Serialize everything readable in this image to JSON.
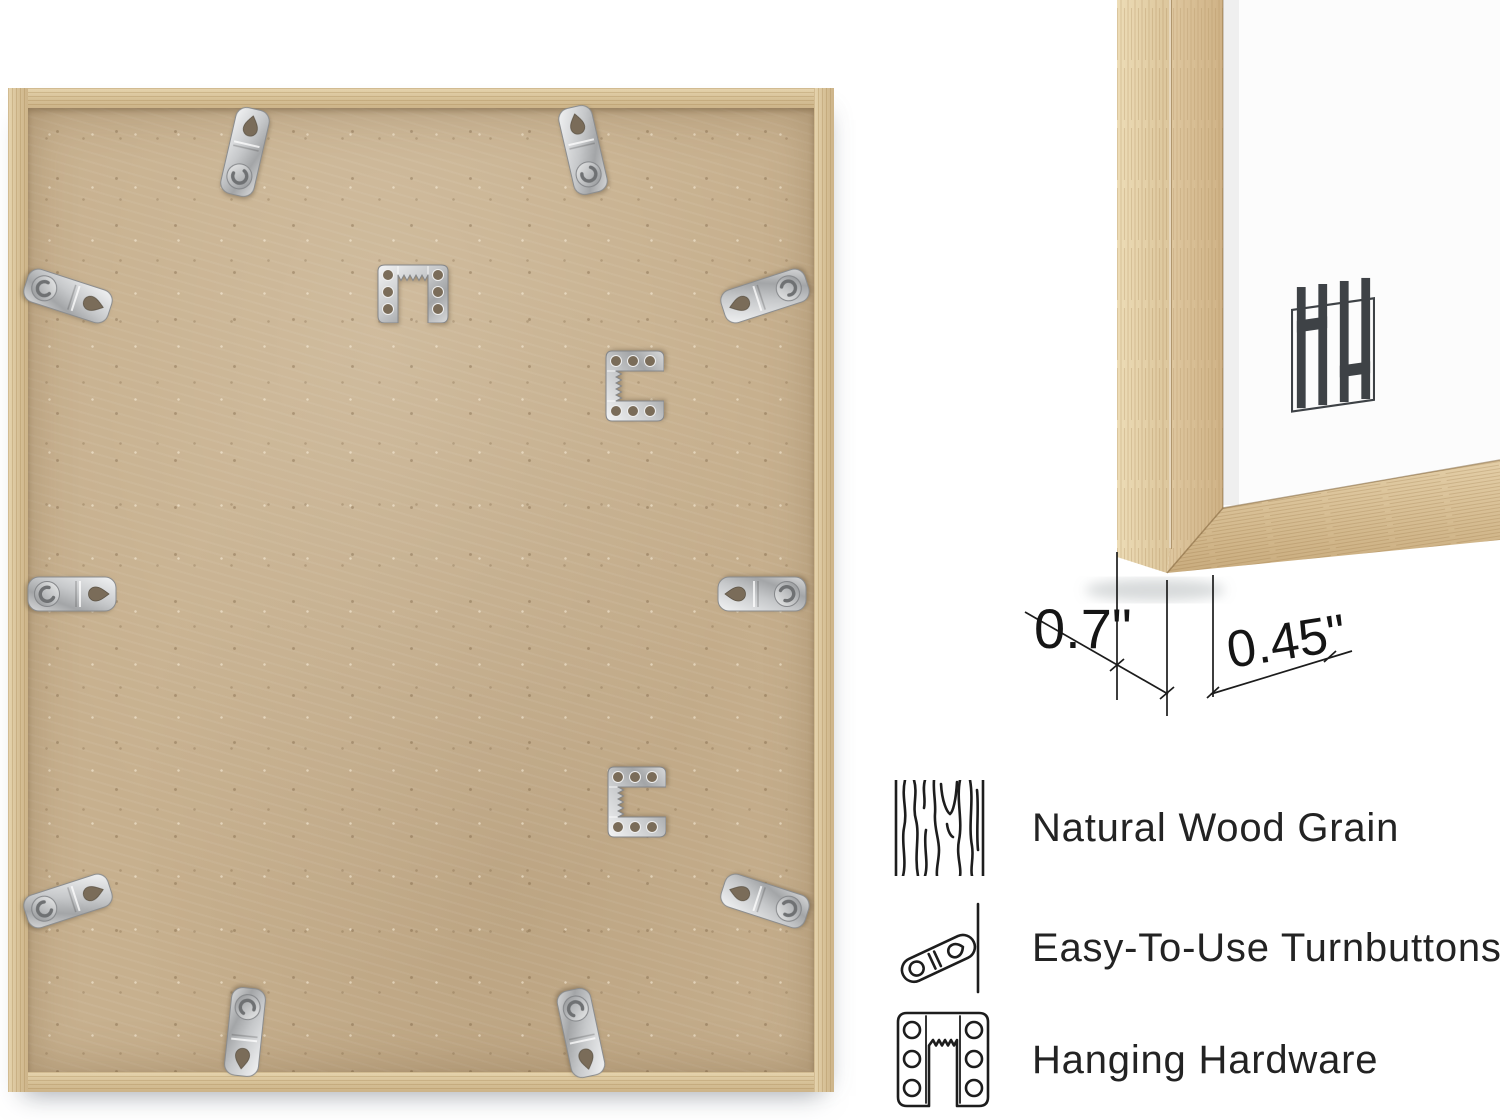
{
  "page": {
    "background": "#ffffff"
  },
  "back_frame_photo": {
    "description": "Back of natural oak picture frame with MDF backing board",
    "wood_color": "#d9c49c",
    "backing_color": "#c7b08e",
    "metal_color": "#c9cbcd",
    "turnbutton_count": 10,
    "sawtooth_hanger_count": 3
  },
  "corner_photo": {
    "description": "Front bottom corner of natural oak frame with white mat",
    "logo_text": "HH",
    "logo_color": "#3e4246",
    "dimensions": [
      {
        "label": "0.7\""
      },
      {
        "label": "0.45\""
      }
    ]
  },
  "features": [
    {
      "icon": "wood-grain-icon",
      "label": "Natural Wood Grain"
    },
    {
      "icon": "turnbutton-icon",
      "label": "Easy-To-Use Turnbuttons"
    },
    {
      "icon": "hanging-hardware-icon",
      "label": "Hanging Hardware"
    }
  ]
}
